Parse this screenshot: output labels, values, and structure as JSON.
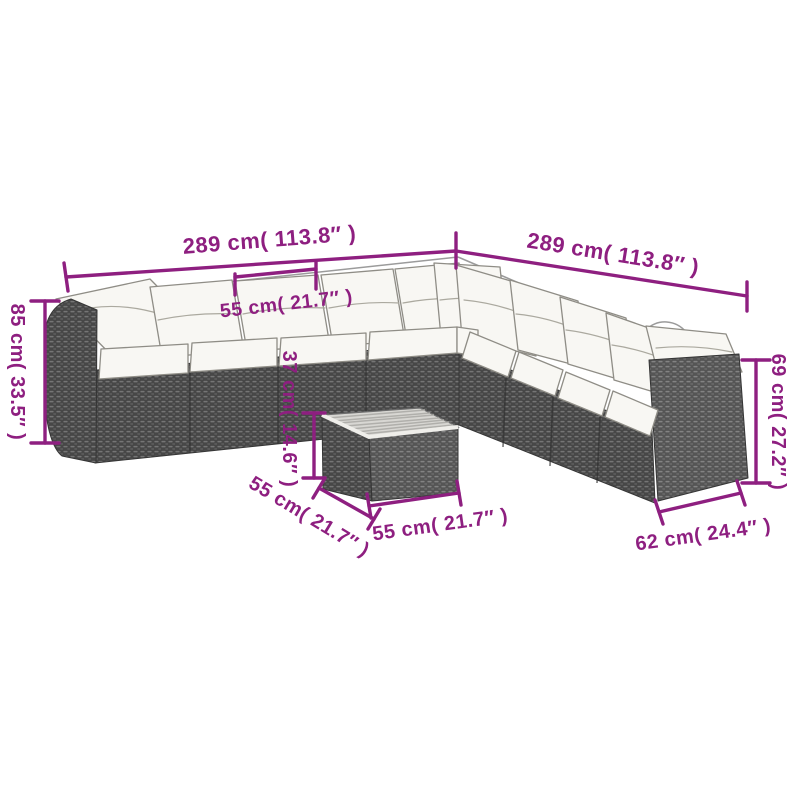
{
  "colors": {
    "background": "#ffffff",
    "annotation": "#8e1f80",
    "rattan": "#4a4a4a",
    "rattan_highlight": "#787878",
    "cushion": "#f8f7f3",
    "cushion_outline": "#8f8d86",
    "table_top": "#d8d7d3"
  },
  "product_diagram": {
    "labels": {
      "back_width_left": "289 cm( 113.8″ )",
      "back_width_right": "289 cm( 113.8″ )",
      "seat_module_width": "55 cm( 21.7″ )",
      "sofa_height_left": "85 cm( 33.5″ )",
      "table_height": "37 cm( 14.6″ )",
      "sofa_height_right": "69 cm( 27.2″ )",
      "table_depth": "55 cm( 21.7″ )",
      "table_width": "55 cm( 21.7″ )",
      "seat_depth_right": "62 cm( 24.4″ )"
    }
  }
}
